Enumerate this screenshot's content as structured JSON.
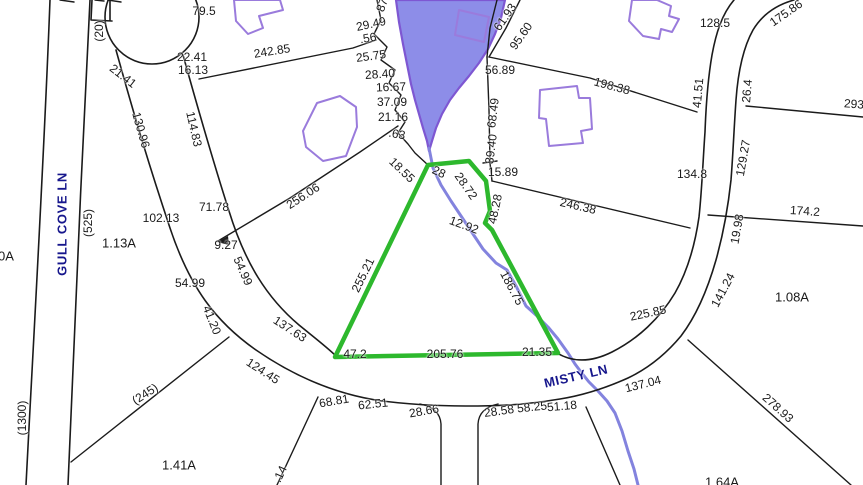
{
  "map": {
    "type": "cadastral-parcel-map",
    "colors": {
      "line": "#1b1b1b",
      "dim_text": "#1a1a1a",
      "street_text": "#16168c",
      "pond_fill": "#8d8de8",
      "pond_stroke": "#7e57d2",
      "stream": "#8383de",
      "highlight": "#2db82d",
      "house": "#9a7bdc"
    },
    "streets": [
      {
        "name": "GULL COVE LN"
      },
      {
        "name": "MISTY LN"
      }
    ],
    "highlighted_parcel": {
      "outline_color": "#2db82d",
      "edge_dimensions": [
        "28",
        "28.72",
        "48.28",
        "12.92",
        "186.75",
        "21.35",
        "205.76",
        "47.2",
        "255.21"
      ]
    },
    "labels": [
      {
        "text": "GULL COVE LN",
        "x": 62,
        "y": 224,
        "r": -90,
        "kind": "street"
      },
      {
        "text": "MISTY LN",
        "x": 576,
        "y": 376,
        "r": -13,
        "kind": "street"
      },
      {
        "text": "(20)",
        "x": 99,
        "y": 31,
        "r": -90,
        "kind": "reference"
      },
      {
        "text": "(525)",
        "x": 88,
        "y": 223,
        "r": -90,
        "kind": "reference"
      },
      {
        "text": "(1300)",
        "x": 22,
        "y": 418,
        "r": -90,
        "kind": "reference"
      },
      {
        "text": "(245)",
        "x": 145,
        "y": 394,
        "r": -33,
        "kind": "reference"
      },
      {
        "text": "1.13A",
        "x": 119,
        "y": 243,
        "r": 0,
        "kind": "area"
      },
      {
        "text": "1.41A",
        "x": 179,
        "y": 465,
        "r": 0,
        "kind": "area"
      },
      {
        "text": "1.08A",
        "x": 792,
        "y": 297,
        "r": 0,
        "kind": "area"
      },
      {
        "text": "1.64A",
        "x": 722,
        "y": 482,
        "r": 0,
        "kind": "area"
      },
      {
        "text": "0A",
        "x": 6,
        "y": 256,
        "r": 0,
        "kind": "area"
      },
      {
        "text": "79.5",
        "x": 204,
        "y": 11,
        "r": 0,
        "kind": "dimension"
      },
      {
        "text": "22.41",
        "x": 192,
        "y": 57,
        "r": 0,
        "kind": "dimension"
      },
      {
        "text": "16.13",
        "x": 193,
        "y": 70,
        "r": 0,
        "kind": "dimension"
      },
      {
        "text": "21.41",
        "x": 123,
        "y": 76,
        "r": 38,
        "kind": "dimension"
      },
      {
        "text": "242.85",
        "x": 272,
        "y": 51,
        "r": -9,
        "kind": "dimension"
      },
      {
        "text": "130.96",
        "x": 141,
        "y": 130,
        "r": 74,
        "kind": "dimension"
      },
      {
        "text": "114.83",
        "x": 194,
        "y": 129,
        "r": 77,
        "kind": "dimension"
      },
      {
        "text": "29.49",
        "x": 371,
        "y": 24,
        "r": -12,
        "kind": "dimension"
      },
      {
        "text": ".56",
        "x": 368,
        "y": 38,
        "r": -10,
        "kind": "dimension"
      },
      {
        "text": "25.75",
        "x": 371,
        "y": 56,
        "r": -8,
        "kind": "dimension"
      },
      {
        "text": "28.40",
        "x": 380,
        "y": 74,
        "r": -4,
        "kind": "dimension"
      },
      {
        "text": "16.67",
        "x": 391,
        "y": 87,
        "r": -2,
        "kind": "dimension"
      },
      {
        "text": "37.09",
        "x": 392,
        "y": 102,
        "r": 0,
        "kind": "dimension"
      },
      {
        "text": "21.16",
        "x": 393,
        "y": 117,
        "r": 0,
        "kind": "dimension"
      },
      {
        "text": ".63",
        "x": 397,
        "y": 134,
        "r": 10,
        "kind": "dimension"
      },
      {
        "text": "87",
        "x": 382,
        "y": 5,
        "r": -70,
        "kind": "fragment"
      },
      {
        "text": "61.93",
        "x": 505,
        "y": 17,
        "r": -55,
        "kind": "dimension"
      },
      {
        "text": "95.60",
        "x": 521,
        "y": 36,
        "r": -55,
        "kind": "dimension"
      },
      {
        "text": "56.89",
        "x": 500,
        "y": 70,
        "r": 0,
        "kind": "dimension"
      },
      {
        "text": "68.49",
        "x": 493,
        "y": 113,
        "r": -83,
        "kind": "dimension"
      },
      {
        "text": "39.40",
        "x": 491,
        "y": 149,
        "r": -83,
        "kind": "dimension"
      },
      {
        "text": "15.89",
        "x": 503,
        "y": 172,
        "r": 0,
        "kind": "dimension"
      },
      {
        "text": "198.38",
        "x": 612,
        "y": 86,
        "r": 15,
        "kind": "dimension"
      },
      {
        "text": "41.51",
        "x": 698,
        "y": 93,
        "r": -85,
        "kind": "dimension"
      },
      {
        "text": "26.4",
        "x": 747,
        "y": 91,
        "r": -85,
        "kind": "dimension"
      },
      {
        "text": "293",
        "x": 854,
        "y": 104,
        "r": 4,
        "kind": "dimension"
      },
      {
        "text": "128.5",
        "x": 715,
        "y": 23,
        "r": 0,
        "kind": "dimension"
      },
      {
        "text": "175.86",
        "x": 786,
        "y": 13,
        "r": -35,
        "kind": "dimension"
      },
      {
        "text": "129.27",
        "x": 743,
        "y": 158,
        "r": -80,
        "kind": "dimension"
      },
      {
        "text": "134.8",
        "x": 692,
        "y": 174,
        "r": 0,
        "kind": "dimension"
      },
      {
        "text": "174.2",
        "x": 805,
        "y": 211,
        "r": 4,
        "kind": "dimension"
      },
      {
        "text": "246.38",
        "x": 578,
        "y": 206,
        "r": 13,
        "kind": "dimension"
      },
      {
        "text": "19.98",
        "x": 737,
        "y": 229,
        "r": -80,
        "kind": "dimension"
      },
      {
        "text": "141.24",
        "x": 723,
        "y": 290,
        "r": -62,
        "kind": "dimension"
      },
      {
        "text": "225.85",
        "x": 648,
        "y": 313,
        "r": -12,
        "kind": "dimension"
      },
      {
        "text": "256.06",
        "x": 303,
        "y": 196,
        "r": -33,
        "kind": "dimension"
      },
      {
        "text": "71.78",
        "x": 214,
        "y": 207,
        "r": 0,
        "kind": "dimension"
      },
      {
        "text": "102.13",
        "x": 161,
        "y": 218,
        "r": 0,
        "kind": "dimension"
      },
      {
        "text": "9.27",
        "x": 226,
        "y": 245,
        "r": 0,
        "kind": "dimension"
      },
      {
        "text": "54.99",
        "x": 190,
        "y": 283,
        "r": 0,
        "kind": "dimension"
      },
      {
        "text": "54.99",
        "x": 243,
        "y": 271,
        "r": 66,
        "kind": "dimension"
      },
      {
        "text": "41.20",
        "x": 212,
        "y": 320,
        "r": 68,
        "kind": "dimension"
      },
      {
        "text": "137.63",
        "x": 290,
        "y": 329,
        "r": 33,
        "kind": "dimension"
      },
      {
        "text": "124.45",
        "x": 263,
        "y": 371,
        "r": 33,
        "kind": "dimension"
      },
      {
        "text": "18.55",
        "x": 402,
        "y": 170,
        "r": 44,
        "kind": "dimension"
      },
      {
        "text": "28",
        "x": 439,
        "y": 172,
        "r": 25,
        "kind": "dimension"
      },
      {
        "text": "28.72",
        "x": 466,
        "y": 186,
        "r": 55,
        "kind": "dimension"
      },
      {
        "text": "12.92",
        "x": 464,
        "y": 225,
        "r": 20,
        "kind": "dimension"
      },
      {
        "text": "48.28",
        "x": 495,
        "y": 209,
        "r": -78,
        "kind": "dimension"
      },
      {
        "text": "255.21",
        "x": 363,
        "y": 275,
        "r": -64,
        "kind": "dimension"
      },
      {
        "text": "186.75",
        "x": 512,
        "y": 288,
        "r": 62,
        "kind": "dimension"
      },
      {
        "text": "47.2",
        "x": 355,
        "y": 354,
        "r": 0,
        "kind": "dimension"
      },
      {
        "text": "205.76",
        "x": 445,
        "y": 354,
        "r": 0,
        "kind": "dimension"
      },
      {
        "text": "21.35",
        "x": 537,
        "y": 352,
        "r": 0,
        "kind": "dimension"
      },
      {
        "text": "137.04",
        "x": 643,
        "y": 384,
        "r": -14,
        "kind": "dimension"
      },
      {
        "text": "278.93",
        "x": 778,
        "y": 408,
        "r": 42,
        "kind": "dimension"
      },
      {
        "text": "68.81",
        "x": 334,
        "y": 401,
        "r": -10,
        "kind": "dimension"
      },
      {
        "text": "62.51",
        "x": 373,
        "y": 404,
        "r": -6,
        "kind": "dimension"
      },
      {
        "text": "28.66",
        "x": 424,
        "y": 411,
        "r": -10,
        "kind": "dimension"
      },
      {
        "text": "28.58",
        "x": 499,
        "y": 411,
        "r": -8,
        "kind": "dimension"
      },
      {
        "text": "58.25",
        "x": 532,
        "y": 407,
        "r": -6,
        "kind": "dimension"
      },
      {
        "text": "51.18",
        "x": 562,
        "y": 406,
        "r": -5,
        "kind": "dimension"
      },
      {
        "text": ".14",
        "x": 280,
        "y": 474,
        "r": -65,
        "kind": "fragment"
      }
    ]
  }
}
